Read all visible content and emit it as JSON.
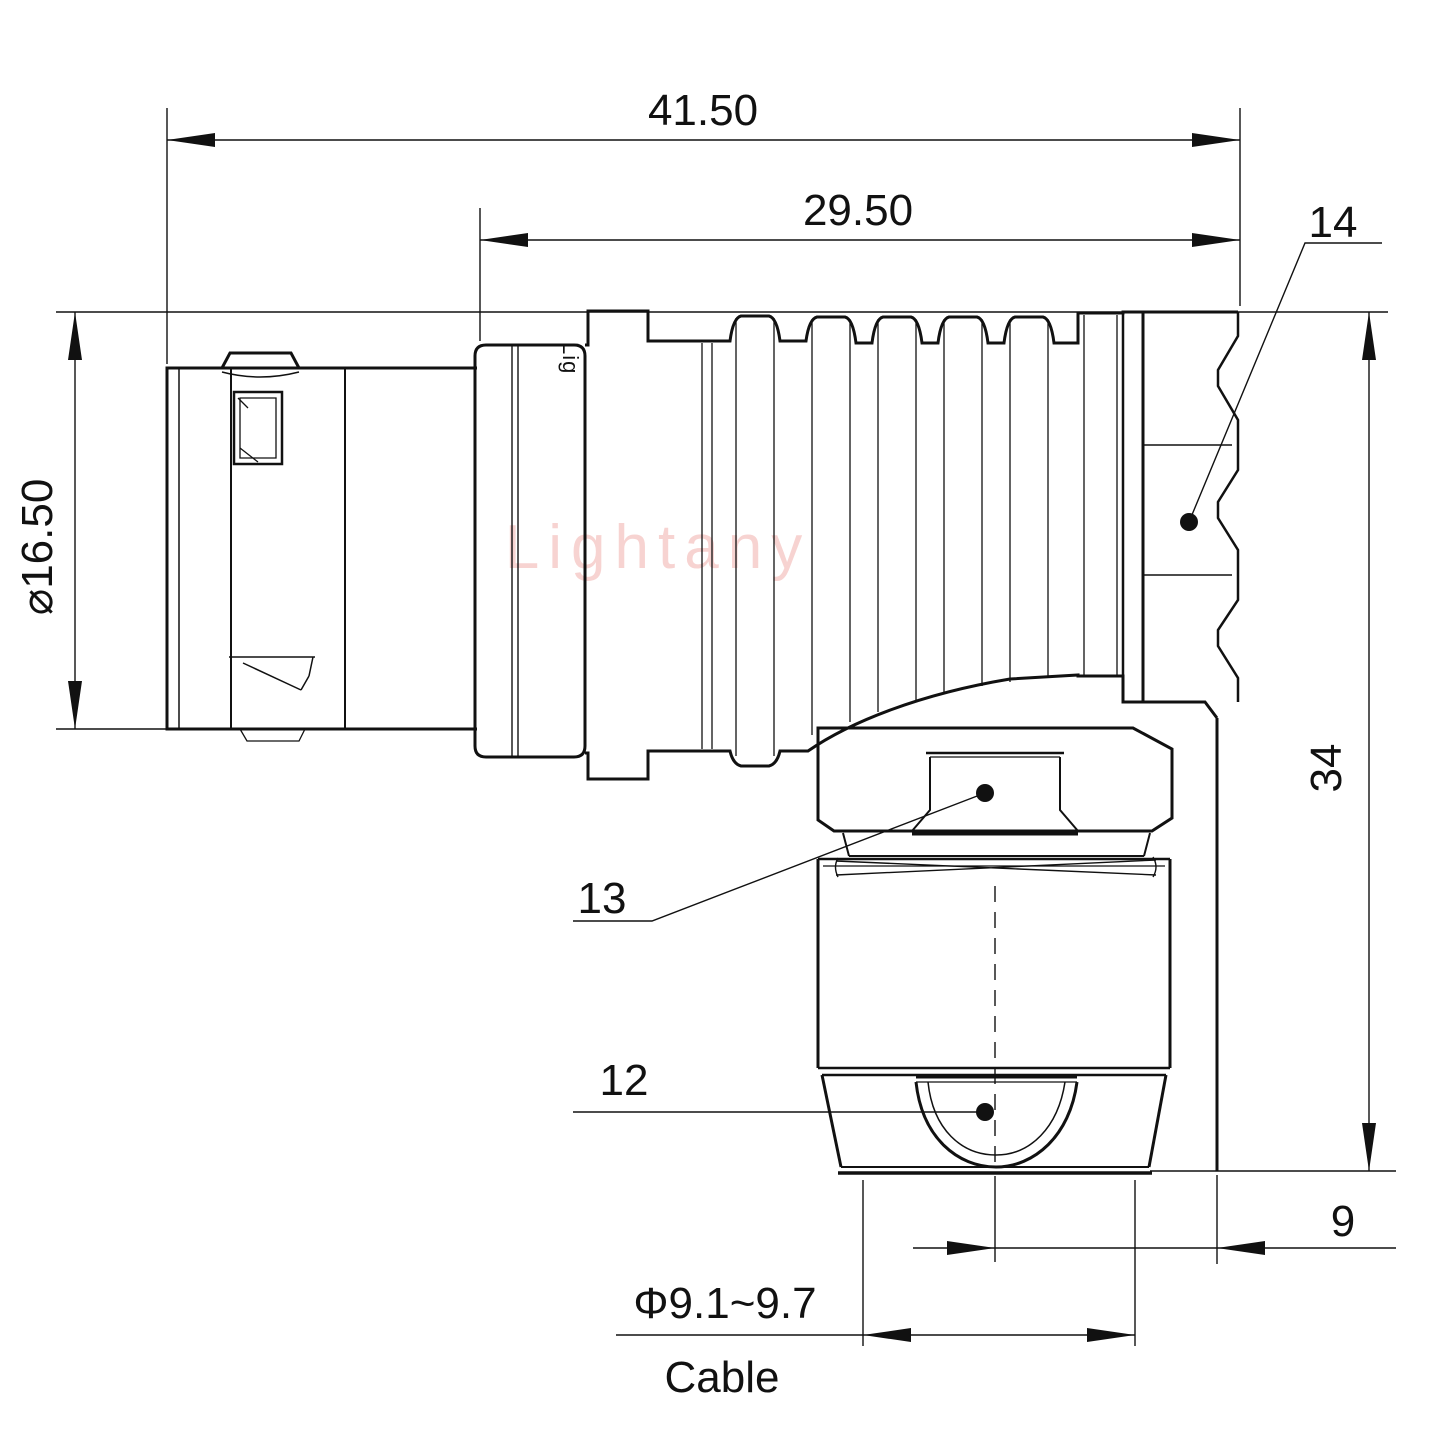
{
  "watermark": "Lightany",
  "body_marking": "Lig",
  "dimensions": {
    "overall_length": "41.50",
    "rear_length": "29.50",
    "shell_diameter": "⌀16.50",
    "height": "34",
    "offset": "9",
    "cable_diameter": "Φ9.1~9.7",
    "cable_label": "Cable"
  },
  "callouts": [
    {
      "id": "14"
    },
    {
      "id": "13"
    },
    {
      "id": "12"
    }
  ],
  "colors": {
    "line": "#111111",
    "watermark": "#f2b7b4",
    "background": "#ffffff"
  }
}
